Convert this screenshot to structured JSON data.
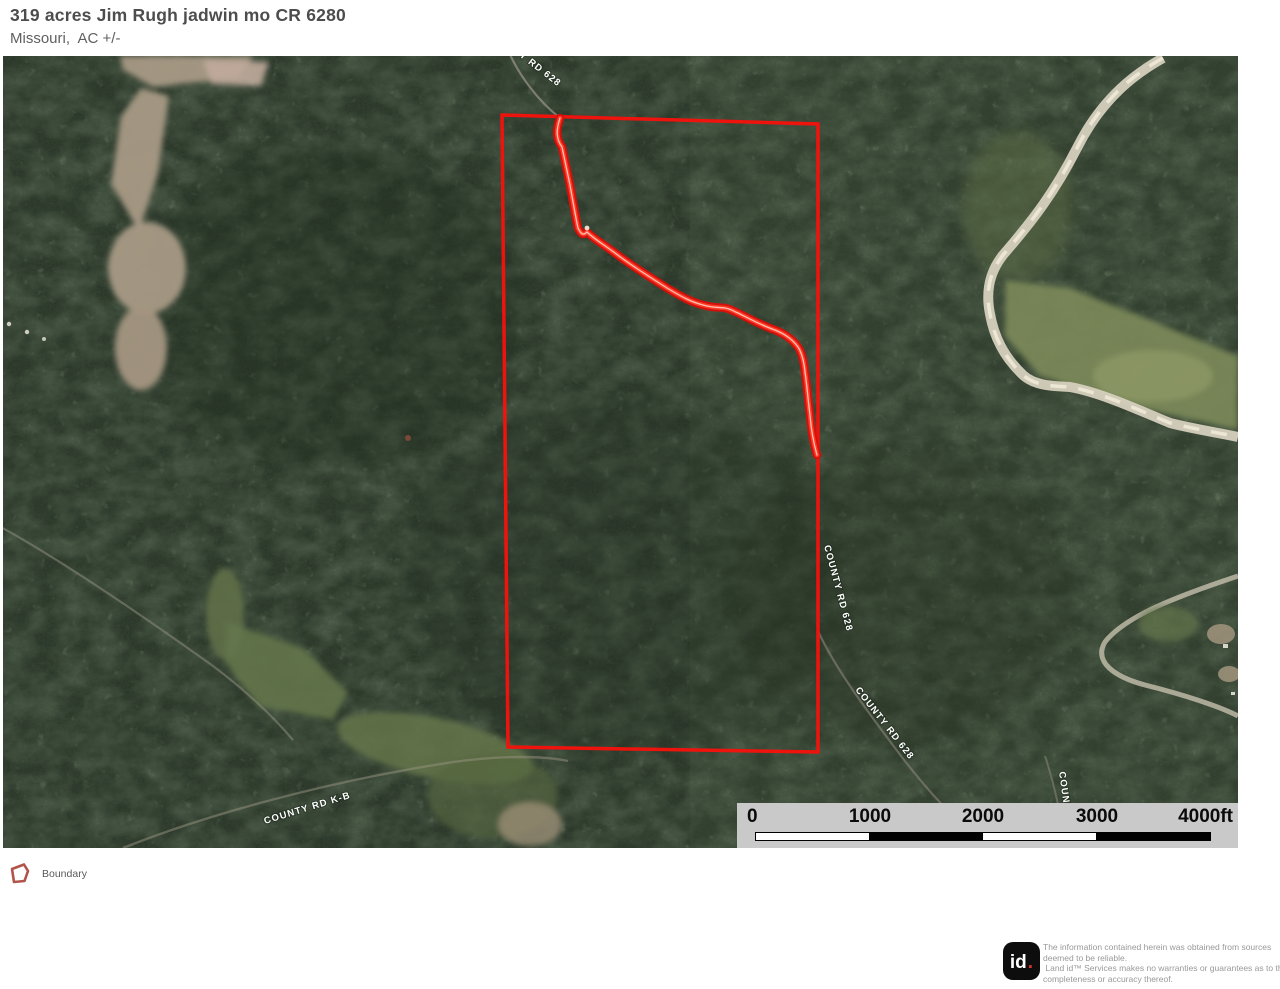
{
  "header": {
    "title": "319 acres Jim Rugh jadwin mo CR 6280",
    "subtitle": "Missouri,  AC +/-"
  },
  "map": {
    "boundary_color": "#f5120c",
    "road_highlight_color": "#ff2012",
    "road_labels": [
      {
        "text": "COUNTY RD 628"
      },
      {
        "text": "COUNTY RD 628"
      },
      {
        "text": "COUNTY RD 628"
      },
      {
        "text": "COUNTY RD 628"
      },
      {
        "text": "COUNTY RD K-B"
      }
    ]
  },
  "scale_bar": {
    "labels": [
      "0",
      "1000",
      "2000",
      "3000",
      "4000ft"
    ]
  },
  "legend": {
    "items": [
      {
        "label": "Boundary",
        "icon": "boundary-polygon-icon",
        "color": "#b2544c"
      }
    ]
  },
  "footer": {
    "logo_text": "id",
    "logo_dot": ".",
    "disclaimer_lines": [
      "The information contained herein was obtained from sources",
      "deemed to be reliable.",
      " Land id™ Services makes no warranties or guarantees as to the",
      "completeness or accuracy thereof."
    ]
  }
}
